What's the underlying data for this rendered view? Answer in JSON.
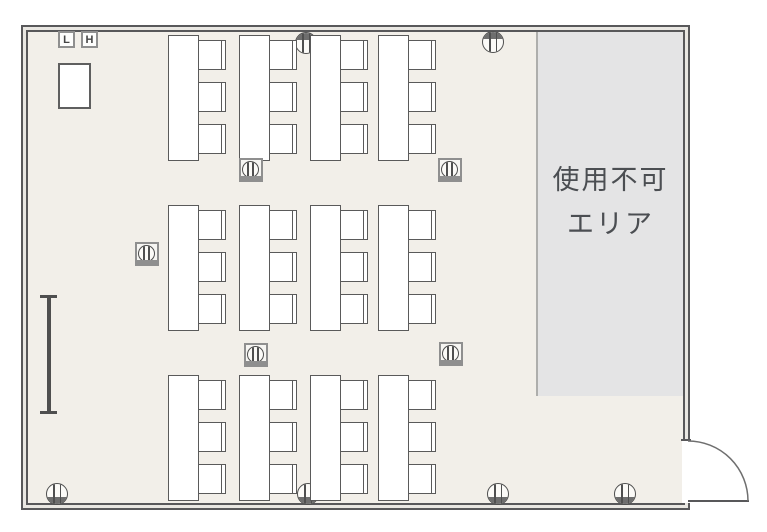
{
  "room": {
    "switch_labels": [
      "L",
      "H"
    ],
    "unusable_area_label": [
      "使用不可",
      "エリア"
    ]
  },
  "layout_facts": {
    "table_rows": 3,
    "tables_per_row": 4,
    "chairs_per_table": 3,
    "wall_circle_symbols": 6,
    "floor_square_symbols": 5,
    "door_count": 1
  },
  "symbols": {
    "wall_circle": "wall-outlet-symbol",
    "floor_square": "floor-outlet-symbol",
    "whiteboard": "whiteboard",
    "lectern": "lectern"
  },
  "colors": {
    "wall_line": "#58585a",
    "floor": "#f2efe9",
    "unusable_fill": "#e4e4e5",
    "label_text": "#4b4e52"
  }
}
